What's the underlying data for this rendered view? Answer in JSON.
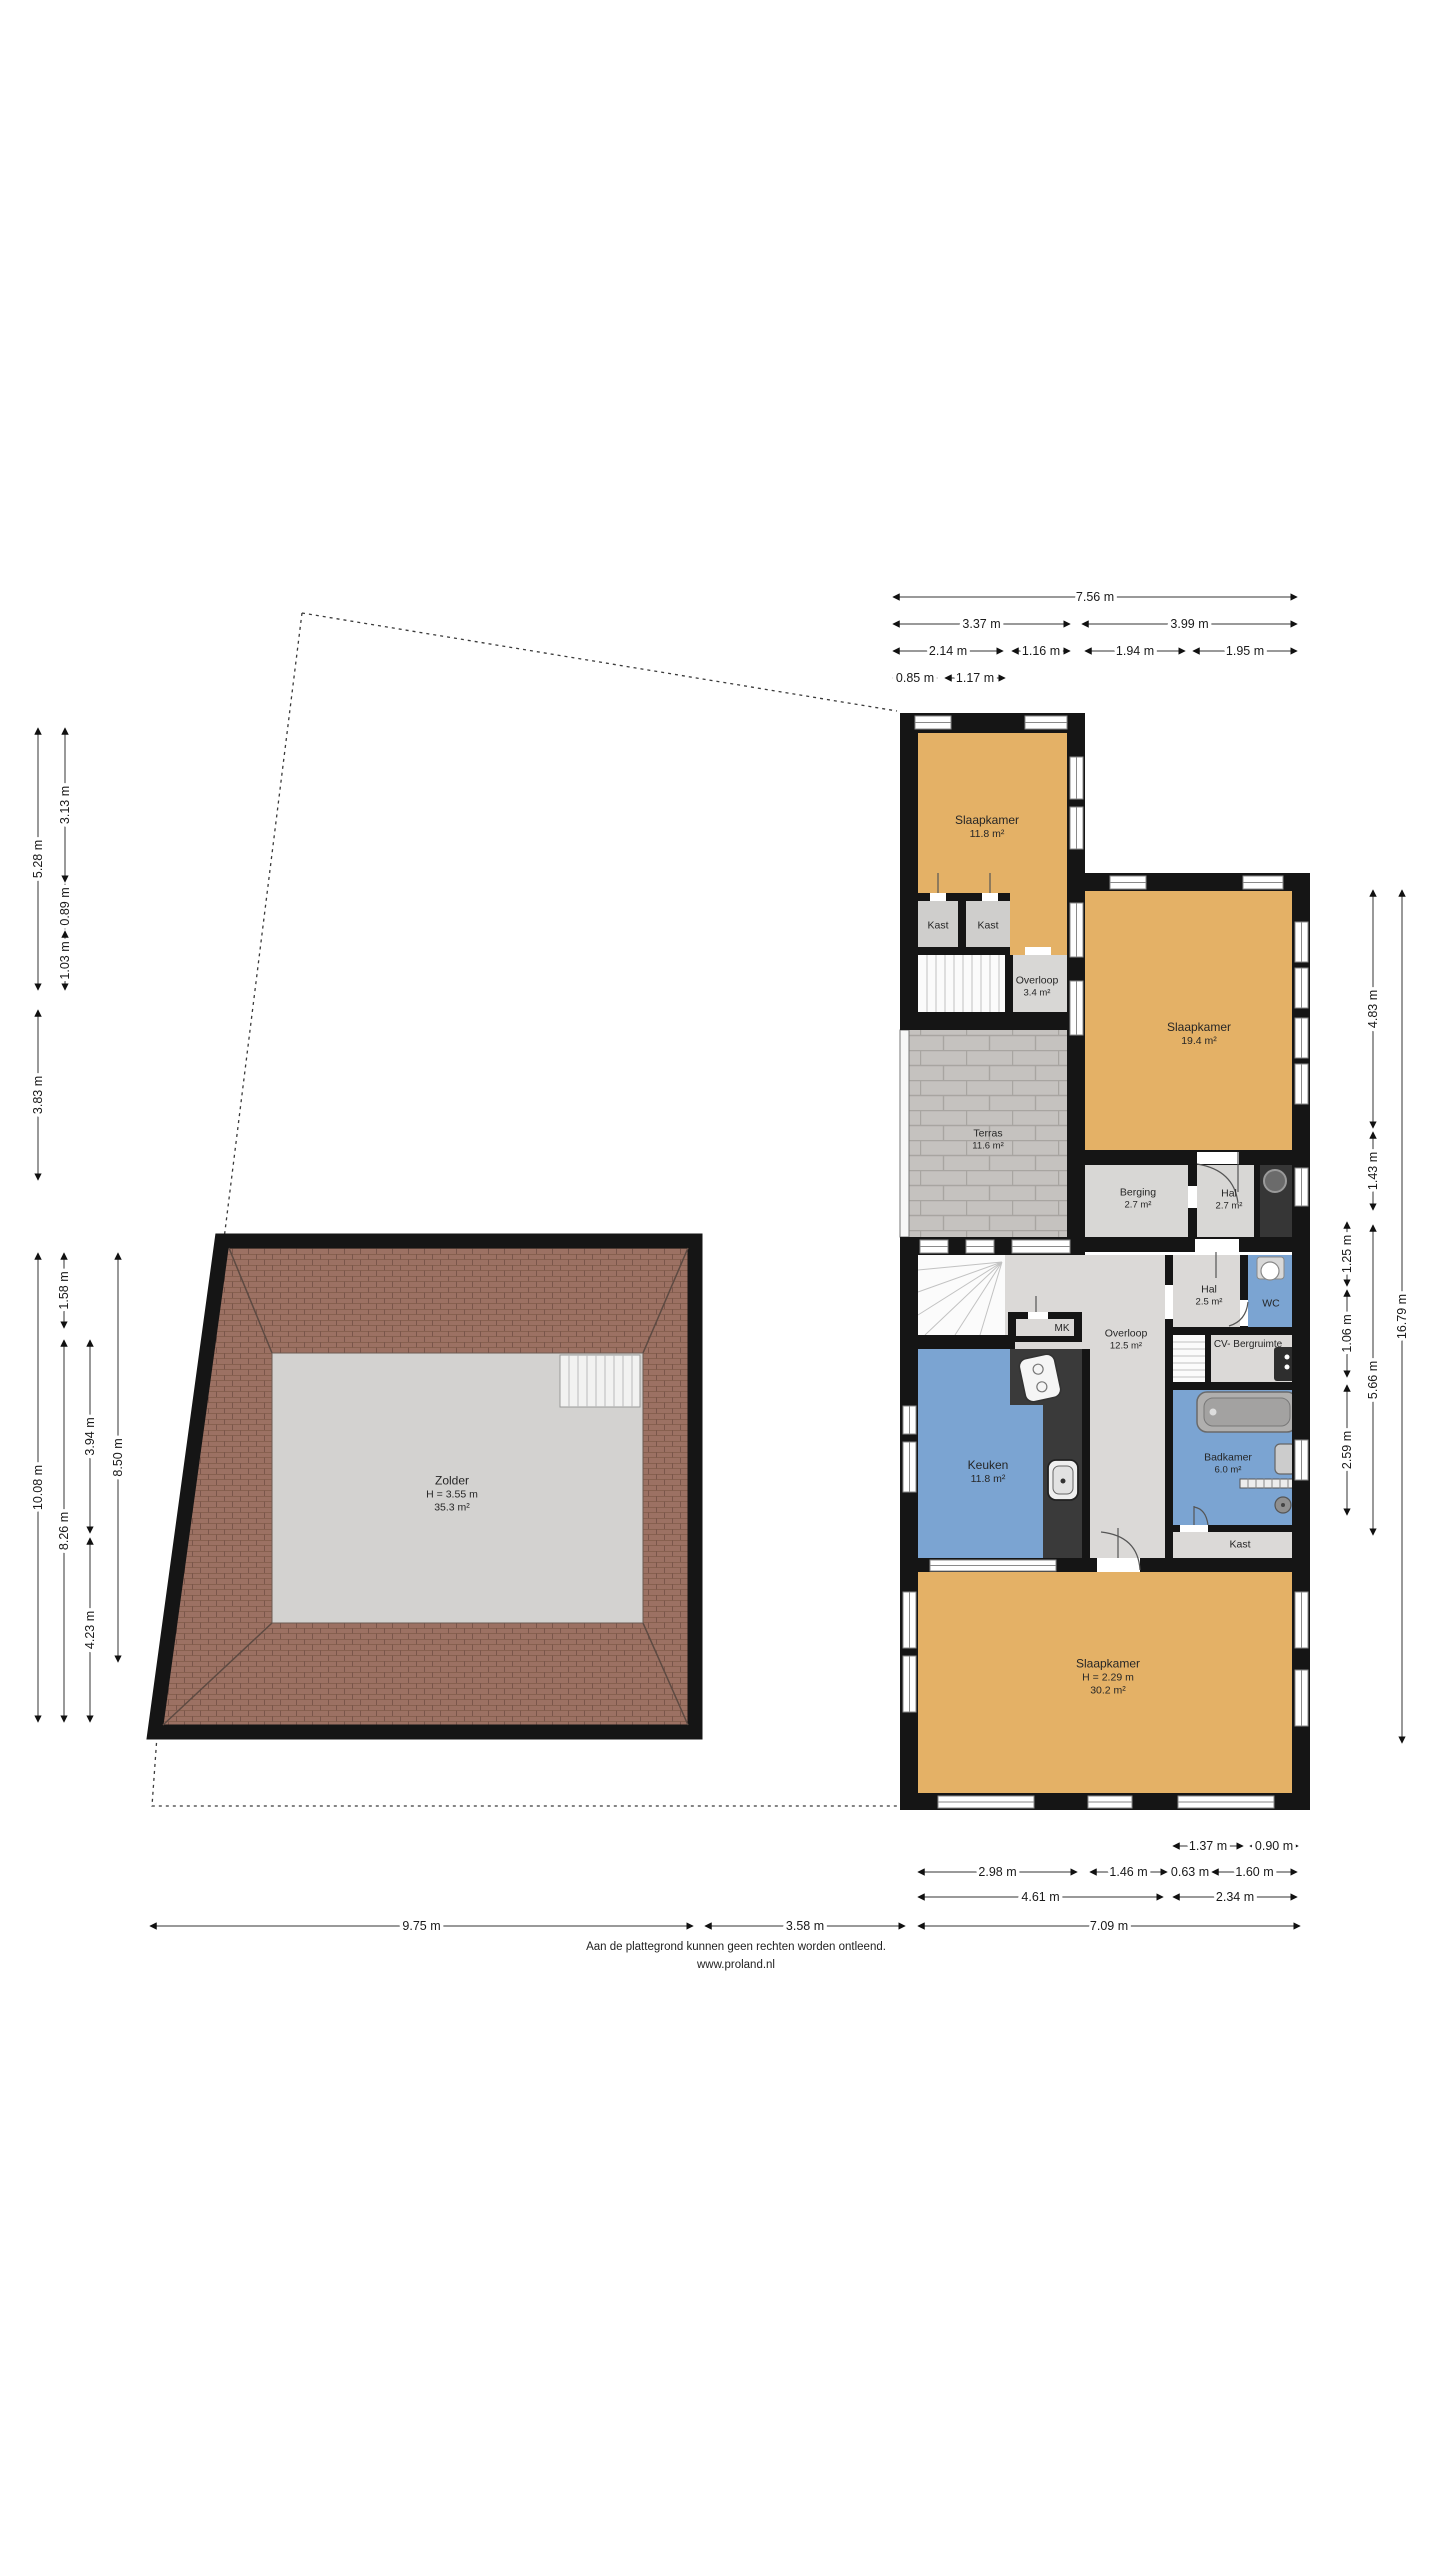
{
  "footer": {
    "line1": "Aan de plattegrond kunnen geen rechten worden ontleend.",
    "line2": "www.proland.nl"
  },
  "colors": {
    "wall": "#151515",
    "bedroom_orange": "#e4b166",
    "room_gray": "#d8d7d5",
    "room_blue": "#7ba4d2",
    "terrace_gray": "#c5c2bf",
    "roof_tile": "#9c7163",
    "attic_floor": "#d3d2d0",
    "counter_dark": "#3a3a3a"
  },
  "rooms": {
    "slaapkamer1": {
      "name": "Slaapkamer",
      "area": "11.8 m²"
    },
    "kast1": {
      "name": "Kast"
    },
    "kast2": {
      "name": "Kast"
    },
    "overloop1": {
      "name": "Overloop",
      "area": "3.4 m²"
    },
    "slaapkamer2": {
      "name": "Slaapkamer",
      "area": "19.4 m²"
    },
    "terras": {
      "name": "Terras",
      "area": "11.6 m²"
    },
    "berging": {
      "name": "Berging",
      "area": "2.7 m²"
    },
    "hal1": {
      "name": "Hal",
      "area": "2.7 m²"
    },
    "hal2": {
      "name": "Hal",
      "area": "2.5 m²"
    },
    "wc": {
      "name": "WC"
    },
    "overloop2": {
      "name": "Overloop",
      "area": "12.5 m²"
    },
    "mk": {
      "name": "MK"
    },
    "cv": {
      "name": "CV- Bergruimte"
    },
    "keuken": {
      "name": "Keuken",
      "area": "11.8 m²"
    },
    "badkamer": {
      "name": "Badkamer",
      "area": "6.0 m²"
    },
    "kast3": {
      "name": "Kast"
    },
    "slaapkamer3": {
      "name": "Slaapkamer",
      "height": "H = 2.29 m",
      "area": "30.2 m²"
    },
    "zolder": {
      "name": "Zolder",
      "height": "H = 3.55 m",
      "area": "35.3 m²"
    }
  },
  "dimensions": [
    {
      "id": "t756",
      "label": "7.56 m"
    },
    {
      "id": "t337",
      "label": "3.37 m"
    },
    {
      "id": "t399",
      "label": "3.99 m"
    },
    {
      "id": "t214",
      "label": "2.14 m"
    },
    {
      "id": "t116",
      "label": "1.16 m"
    },
    {
      "id": "t194",
      "label": "1.94 m"
    },
    {
      "id": "t195",
      "label": "1.95 m"
    },
    {
      "id": "t085",
      "label": "0.85 m"
    },
    {
      "id": "t117",
      "label": "1.17 m"
    },
    {
      "id": "l528",
      "label": "5.28 m"
    },
    {
      "id": "l383",
      "label": "3.83 m"
    },
    {
      "id": "l313",
      "label": "3.13 m"
    },
    {
      "id": "l089",
      "label": "0.89 m"
    },
    {
      "id": "l103",
      "label": "1.03 m"
    },
    {
      "id": "l1008",
      "label": "10.08 m"
    },
    {
      "id": "l158",
      "label": "1.58 m"
    },
    {
      "id": "l826",
      "label": "8.26 m"
    },
    {
      "id": "l394",
      "label": "3.94 m"
    },
    {
      "id": "l423",
      "label": "4.23 m"
    },
    {
      "id": "l850",
      "label": "8.50 m"
    },
    {
      "id": "r125",
      "label": "1.25 m"
    },
    {
      "id": "r106",
      "label": "1.06 m"
    },
    {
      "id": "r259",
      "label": "2.59 m"
    },
    {
      "id": "r483",
      "label": "4.83 m"
    },
    {
      "id": "r143",
      "label": "1.43 m"
    },
    {
      "id": "r566",
      "label": "5.66 m"
    },
    {
      "id": "r1679",
      "label": "16.79 m"
    },
    {
      "id": "b137",
      "label": "1.37 m"
    },
    {
      "id": "b090",
      "label": "0.90 m"
    },
    {
      "id": "b298",
      "label": "2.98 m"
    },
    {
      "id": "b146",
      "label": "1.46 m"
    },
    {
      "id": "b063",
      "label": "0.63 m"
    },
    {
      "id": "b160",
      "label": "1.60 m"
    },
    {
      "id": "b461",
      "label": "4.61 m"
    },
    {
      "id": "b234",
      "label": "2.34 m"
    },
    {
      "id": "b975",
      "label": "9.75 m"
    },
    {
      "id": "b358",
      "label": "3.58 m"
    },
    {
      "id": "b709",
      "label": "7.09 m"
    }
  ]
}
